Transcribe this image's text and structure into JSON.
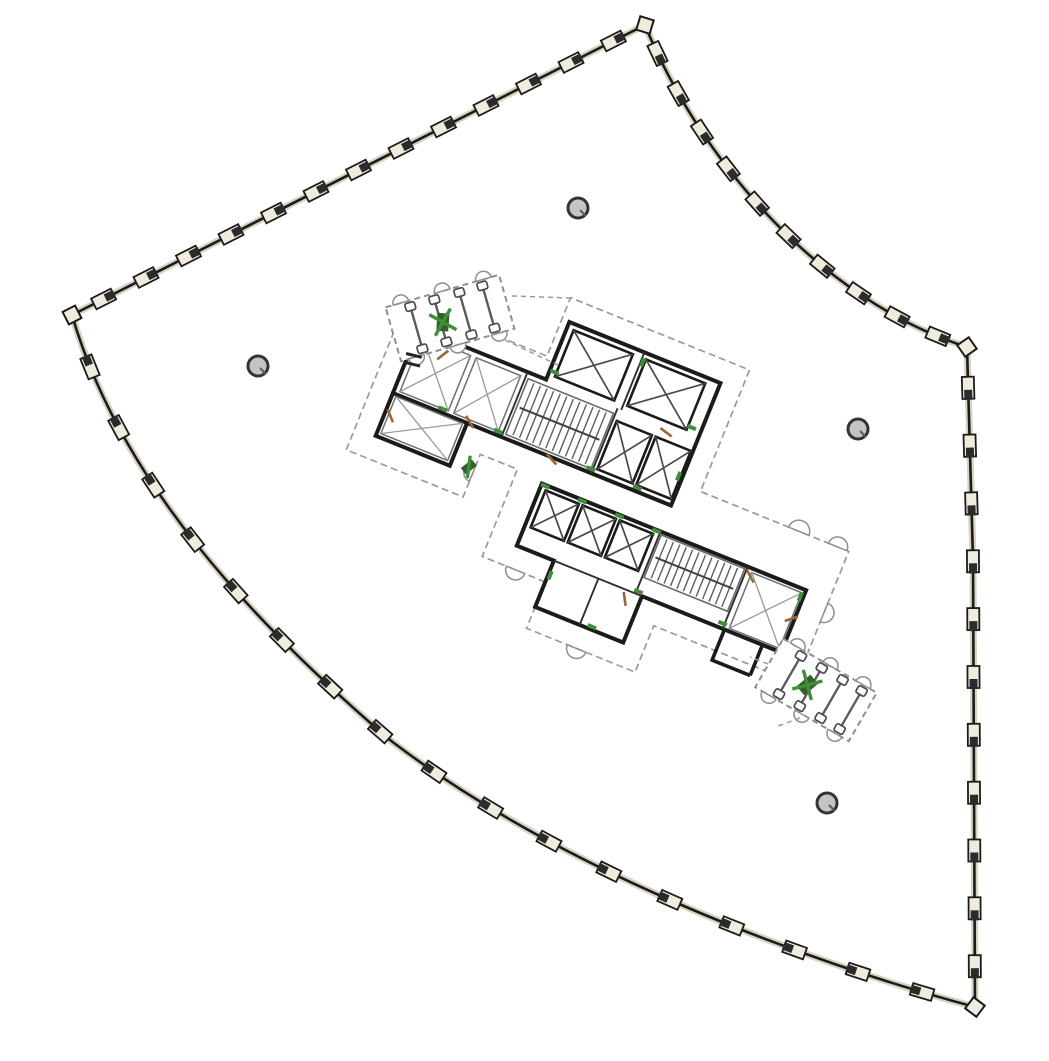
{
  "canvas": {
    "width": 1049,
    "height": 1061,
    "background": "#ffffff"
  },
  "palette": {
    "wall": "#1b1b1b",
    "wall_halo": "#d8d3c1",
    "mullion_fill": "#f0ecdd",
    "mullion_dark": "#2b2b2b",
    "light_line": "#8f8f8f",
    "dashed": "#9a9a9a",
    "green": "#3f8f3a",
    "tan": "#96683c",
    "column_fill": "#c4c4c4",
    "column_ring": "#333333",
    "background": "#ffffff"
  },
  "boundary": {
    "mullion": {
      "w": 22,
      "h": 12,
      "dark_w": 10,
      "dark_h": 8
    },
    "edges": [
      {
        "name": "facade-northwest",
        "path": "M72,315 L645,25",
        "mullions": 13
      },
      {
        "name": "facade-northeast",
        "path": "M645,25 C700,160 820,300 967,347",
        "mullions": 10
      },
      {
        "name": "facade-east",
        "path": "M967,347 L973,560 L975,1007",
        "mullions": 11
      },
      {
        "name": "facade-south",
        "path": "M975,1007 C800,960 560,870 390,740 C250,620 120,480 72,315",
        "mullions": 17
      }
    ],
    "corners": [
      {
        "x": 72,
        "y": 315,
        "angle": -27
      },
      {
        "x": 645,
        "y": 25,
        "angle": 17
      },
      {
        "x": 967,
        "y": 347,
        "angle": 55
      },
      {
        "x": 975,
        "y": 1007,
        "angle": 37
      }
    ]
  },
  "columns": [
    {
      "x": 578,
      "y": 208
    },
    {
      "x": 258,
      "y": 366
    },
    {
      "x": 858,
      "y": 429
    },
    {
      "x": 827,
      "y": 803
    }
  ],
  "core": {
    "center": {
      "x": 608,
      "y": 480
    },
    "angle": 22,
    "dashed_outline": "M-254,-92 H-103 V-155 H90 V-24 H250 V118 H97 V168 H-20 V118 H-88 V24 H-128 V70 H-254 Z",
    "scallops": [
      {
        "x": 196,
        "y": -24,
        "r": 11,
        "rot": 0
      },
      {
        "x": 238,
        "y": -24,
        "r": 10,
        "rot": 0
      },
      {
        "x": -52,
        "y": 118,
        "r": 10,
        "rot": 180
      },
      {
        "x": 34,
        "y": 168,
        "r": 10,
        "rot": 180
      },
      {
        "x": 250,
        "y": 42,
        "r": 10,
        "rot": 90
      },
      {
        "x": -128,
        "y": 44,
        "r": 9,
        "rot": 270
      }
    ],
    "banks": [
      {
        "name": "core-bank-upper",
        "outline": "M-232,-70 H-95 V-132 H68 V0 H-232 Z"
      },
      {
        "name": "core-annex-west",
        "outline": "M-232,0 H-152 V46 H-232 Z"
      },
      {
        "name": "core-bank-lower",
        "outline": "M-60,28 H225 V95 H75 V145 H-20 V95 H-60 Z"
      }
    ],
    "x_rooms": [
      [
        -226,
        -64,
        52,
        60
      ],
      [
        -168,
        -64,
        48,
        60
      ],
      [
        168,
        32,
        54,
        60
      ],
      [
        -228,
        2,
        72,
        40
      ]
    ],
    "stairs": [
      {
        "x": -112,
        "y": -64,
        "w": 92,
        "h": 60,
        "treads": 13
      },
      {
        "x": 70,
        "y": 31,
        "w": 90,
        "h": 46,
        "treads": 13
      }
    ],
    "shafts": [
      [
        -88,
        -126,
        64,
        50
      ],
      [
        -10,
        -126,
        64,
        50
      ],
      [
        -14,
        -58,
        38,
        52
      ],
      [
        28,
        -58,
        38,
        52
      ],
      [
        -54,
        33,
        36,
        40
      ],
      [
        -14,
        33,
        36,
        40
      ],
      [
        26,
        33,
        36,
        40
      ]
    ],
    "partitions": [
      "M-115,-70 V0",
      "M-18,-70 V0",
      "M-14,-132 V-70",
      "M68,28 V95",
      "M162,28 V95",
      "M-20,95 H75",
      "M28,95 V145"
    ],
    "extra_walls": [
      "M164,95 V128 H205",
      "M205,95 V128"
    ],
    "green_marks": [
      [
        -90,
        -80,
        0
      ],
      [
        58,
        -80,
        0
      ],
      [
        -12,
        -122,
        90
      ],
      [
        -230,
        -40,
        90
      ],
      [
        -214,
        -66,
        30
      ],
      [
        -180,
        -4,
        0
      ],
      [
        -120,
        -4,
        0
      ],
      [
        -20,
        -4,
        0
      ],
      [
        30,
        -4,
        0
      ],
      [
        64,
        -30,
        90
      ],
      [
        -56,
        29,
        0
      ],
      [
        -16,
        29,
        0
      ],
      [
        24,
        29,
        0
      ],
      [
        64,
        29,
        0
      ],
      [
        160,
        90,
        0
      ],
      [
        222,
        36,
        90
      ],
      [
        70,
        92,
        0
      ],
      [
        -18,
        110,
        90
      ],
      [
        40,
        142,
        0
      ]
    ],
    "tan_marks": [
      [
        -150,
        -2,
        38
      ],
      [
        -200,
        -54,
        120
      ],
      [
        -226,
        22,
        45
      ],
      [
        168,
        36,
        40
      ],
      [
        60,
        104,
        60
      ],
      [
        222,
        60,
        140
      ],
      [
        -60,
        2,
        25
      ],
      [
        36,
        -66,
        15
      ]
    ],
    "fixtures": [
      {
        "x": -134,
        "y": 40,
        "rot": 30
      }
    ]
  },
  "appendages": [
    {
      "name": "vestibule-northwest",
      "cx": 450,
      "cy": 318,
      "angle": -16,
      "w": 118,
      "h": 56,
      "barbells": [
        -35,
        -10,
        16,
        40
      ],
      "green_cross": {
        "x": -8,
        "y": 2
      },
      "ticks": true
    },
    {
      "name": "vestibule-southeast",
      "cx": 816,
      "cy": 690,
      "angle": 30,
      "w": 108,
      "h": 56,
      "barbells": [
        -30,
        -6,
        18,
        40
      ],
      "green_cross": {
        "x": -10,
        "y": 0
      },
      "ticks": false
    }
  ],
  "connectors": [
    "M505,340 L560,366",
    "M512,296 L571,298",
    "M768,664 L750,657",
    "M800,718 L778,726"
  ]
}
